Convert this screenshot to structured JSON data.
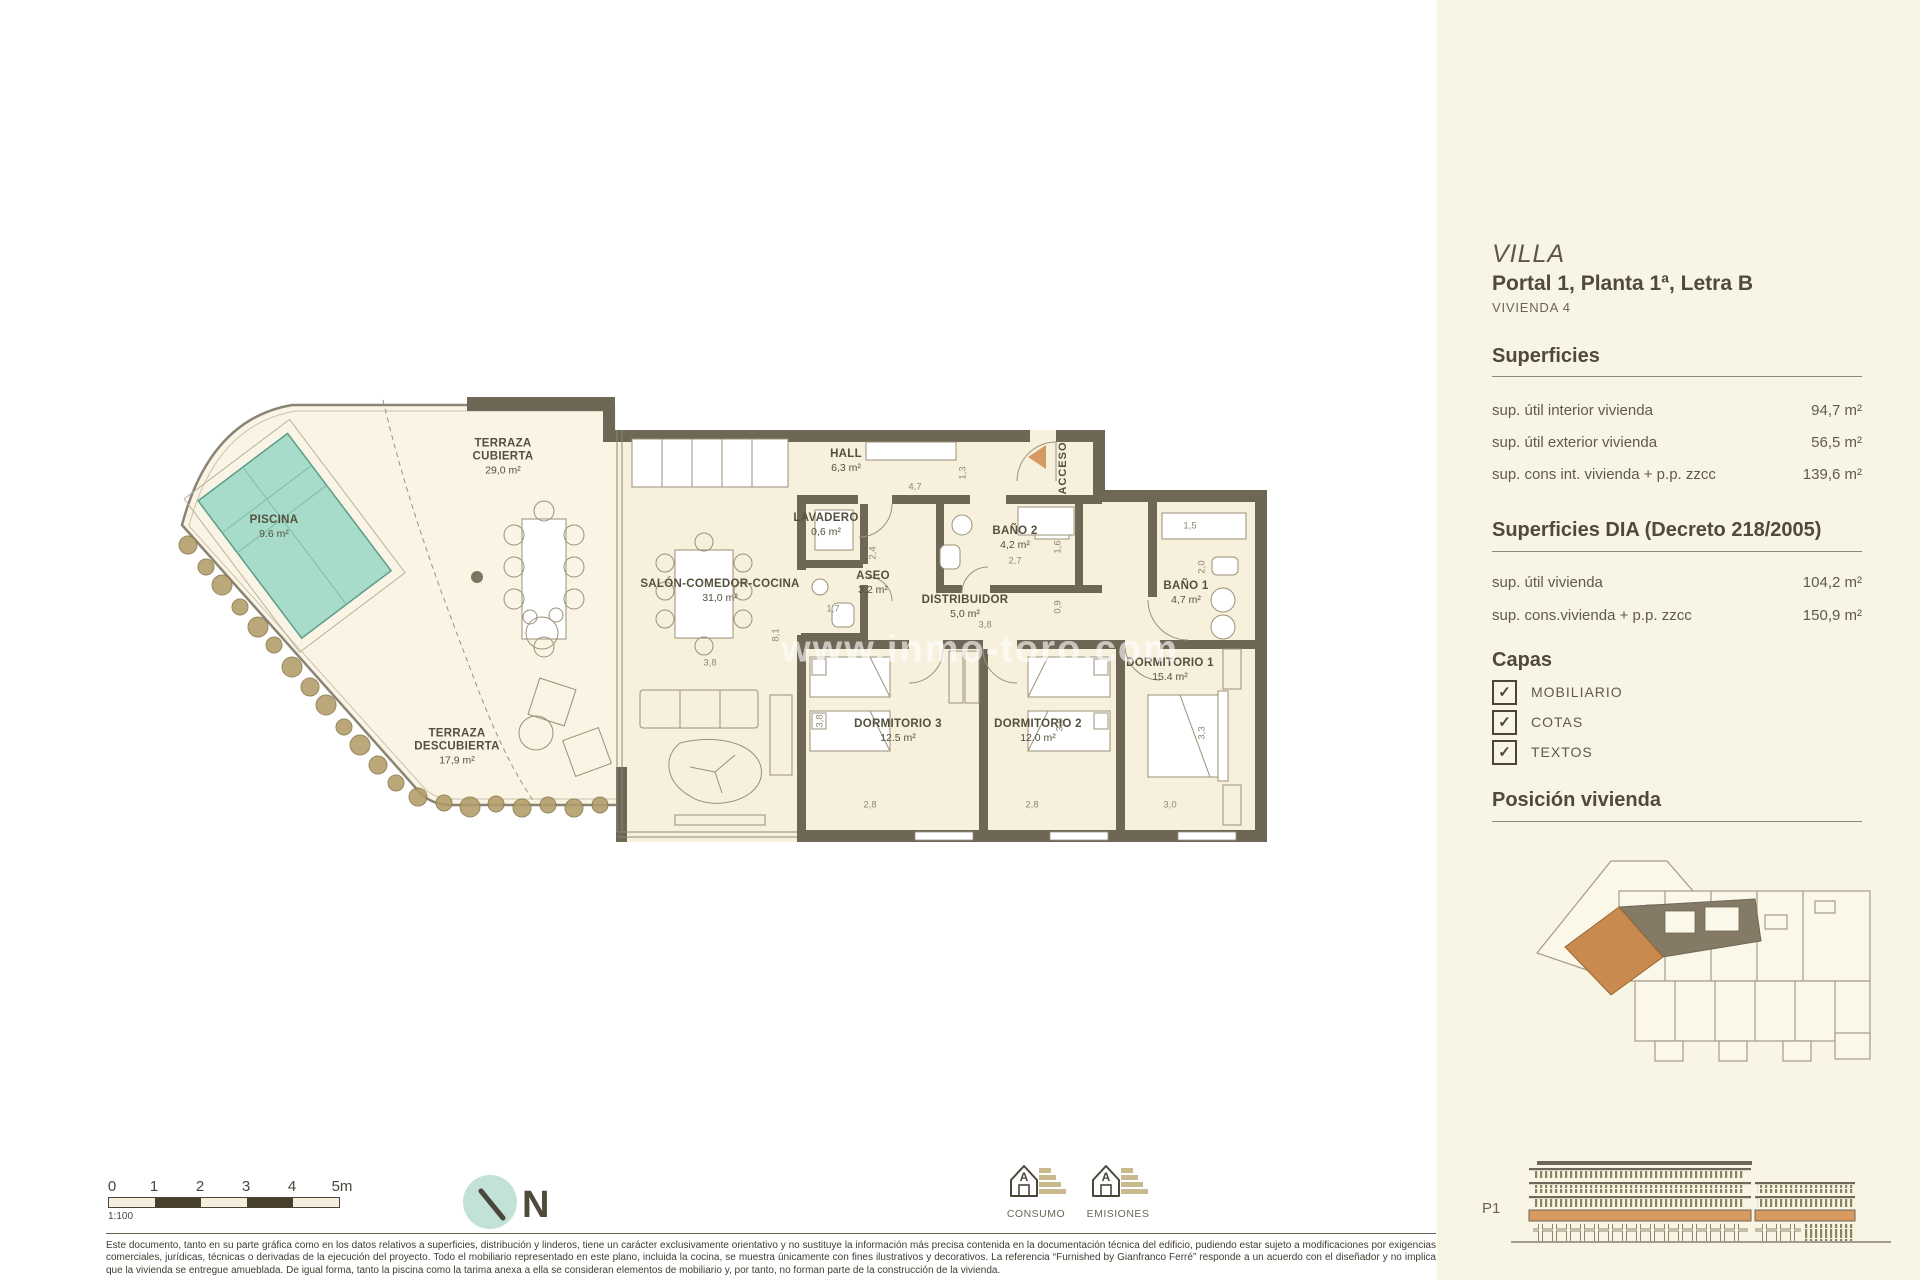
{
  "colors": {
    "sidebar_bg": "#f9f5e4",
    "wall": "#6e6756",
    "floor": "#f6f0dc",
    "parcel": "#f9f4e4",
    "pool_fill": "#a6dcc9",
    "pool_stroke": "#5d9c89",
    "accent_orange": "#d08c52",
    "vegetation": "#b19d68",
    "north_circle": "#c3e2d7"
  },
  "sidebar": {
    "title": "VILLA",
    "subtitle": "Portal 1, Planta 1ª, Letra B",
    "unit": "VIVIENDA 4",
    "superficies": {
      "heading": "Superficies",
      "rows": [
        {
          "label": "sup. útil interior vivienda",
          "value": "94,7 m²"
        },
        {
          "label": "sup. útil exterior vivienda",
          "value": "56,5 m²"
        },
        {
          "label": "sup. cons int. vivienda + p.p. zzcc",
          "value": "139,6 m²"
        }
      ]
    },
    "superficies_dia": {
      "heading": "Superficies DIA (Decreto 218/2005)",
      "rows": [
        {
          "label": "sup. útil  vivienda",
          "value": "104,2 m²"
        },
        {
          "label": "sup. cons.vivienda + p.p. zzcc",
          "value": "150,9 m²"
        }
      ]
    },
    "capas": {
      "heading": "Capas",
      "items": [
        {
          "label": "MOBILIARIO",
          "checked": "✓"
        },
        {
          "label": "COTAS",
          "checked": "✓"
        },
        {
          "label": "TEXTOS",
          "checked": "✓"
        }
      ]
    },
    "posicion_heading": "Posición vivienda",
    "elevation_label": "P1"
  },
  "plan": {
    "acceso_label": "ACCESO",
    "watermark": "www.inmo-toro.com",
    "rooms": [
      {
        "name": "TERRAZA\nCUBIERTA",
        "area": "29,0 m²",
        "x": 333,
        "y": 62
      },
      {
        "name": "PISCINA",
        "area": "9.6 m²",
        "x": 104,
        "y": 132
      },
      {
        "name": "SALÓN-COMEDOR-COCINA",
        "area": "31,0 m²",
        "x": 550,
        "y": 196
      },
      {
        "name": "HALL",
        "area": "6,3 m²",
        "x": 676,
        "y": 66
      },
      {
        "name": "LAVADERO",
        "area": "0,6 m²",
        "x": 656,
        "y": 130
      },
      {
        "name": "ASEO",
        "area": "3,2 m²",
        "x": 703,
        "y": 188
      },
      {
        "name": "BAÑO 2",
        "area": "4,2 m²",
        "x": 845,
        "y": 143
      },
      {
        "name": "DISTRIBUIDOR",
        "area": "5,0 m²",
        "x": 795,
        "y": 212
      },
      {
        "name": "BAÑO 1",
        "area": "4,7 m²",
        "x": 1016,
        "y": 198
      },
      {
        "name": "DORMITORIO 1",
        "area": "15.4 m²",
        "x": 1000,
        "y": 275
      },
      {
        "name": "DORMITORIO 2",
        "area": "12.0 m²",
        "x": 868,
        "y": 336
      },
      {
        "name": "DORMITORIO 3",
        "area": "12.5 m²",
        "x": 728,
        "y": 336
      },
      {
        "name": "TERRAZA\nDESCUBIERTA",
        "area": "17,9 m²",
        "x": 287,
        "y": 352
      }
    ],
    "dims": [
      {
        "t": "4,7",
        "x": 745,
        "y": 92
      },
      {
        "t": "1,3",
        "x": 793,
        "y": 78,
        "v": 1
      },
      {
        "t": "2,4",
        "x": 703,
        "y": 158,
        "v": 1
      },
      {
        "t": "1,7",
        "x": 663,
        "y": 214
      },
      {
        "t": "2,7",
        "x": 845,
        "y": 166
      },
      {
        "t": "1,6",
        "x": 888,
        "y": 152,
        "v": 1
      },
      {
        "t": "3,8",
        "x": 815,
        "y": 230
      },
      {
        "t": "0,9",
        "x": 888,
        "y": 212,
        "v": 1
      },
      {
        "t": "8,1",
        "x": 606,
        "y": 240,
        "v": 1
      },
      {
        "t": "3,8",
        "x": 540,
        "y": 268
      },
      {
        "t": "2,8",
        "x": 700,
        "y": 410
      },
      {
        "t": "3,8",
        "x": 650,
        "y": 326,
        "v": 1
      },
      {
        "t": "2,8",
        "x": 862,
        "y": 410
      },
      {
        "t": "3,9",
        "x": 890,
        "y": 330,
        "v": 1
      },
      {
        "t": "1,5",
        "x": 1020,
        "y": 131
      },
      {
        "t": "2,0",
        "x": 1032,
        "y": 172,
        "v": 1
      },
      {
        "t": "3,3",
        "x": 1032,
        "y": 338,
        "v": 1
      },
      {
        "t": "3,0",
        "x": 1000,
        "y": 410
      }
    ]
  },
  "footer": {
    "scale": {
      "ticks": [
        "0",
        "1",
        "2",
        "3",
        "4",
        "5m"
      ],
      "ratio": "1:100"
    },
    "north_label": "N",
    "energy": [
      {
        "label": "CONSUMO"
      },
      {
        "label": "EMISIONES"
      }
    ],
    "disclaimer": "Este documento, tanto en su parte gráfica como en los datos relativos a superficies, distribución y linderos, tiene un carácter exclusivamente orientativo y no sustituye la información más precisa contenida en la documentación técnica del edificio, pudiendo estar sujeto a modificaciones por exigencias comerciales, jurídicas, técnicas o derivadas de la ejecución del proyecto. Todo el mobiliario representado en este plano, incluida la cocina, se muestra únicamente con fines ilustrativos y decorativos. La referencia “Furnished by Gianfranco Ferré” responde a un acuerdo con el diseñador y no implica que la vivienda se entregue amueblada. De igual forma, tanto la piscina como la tarima anexa a ella se consideran elementos de mobiliario y, por tanto, no forman parte de la construcción de la vivienda."
  }
}
